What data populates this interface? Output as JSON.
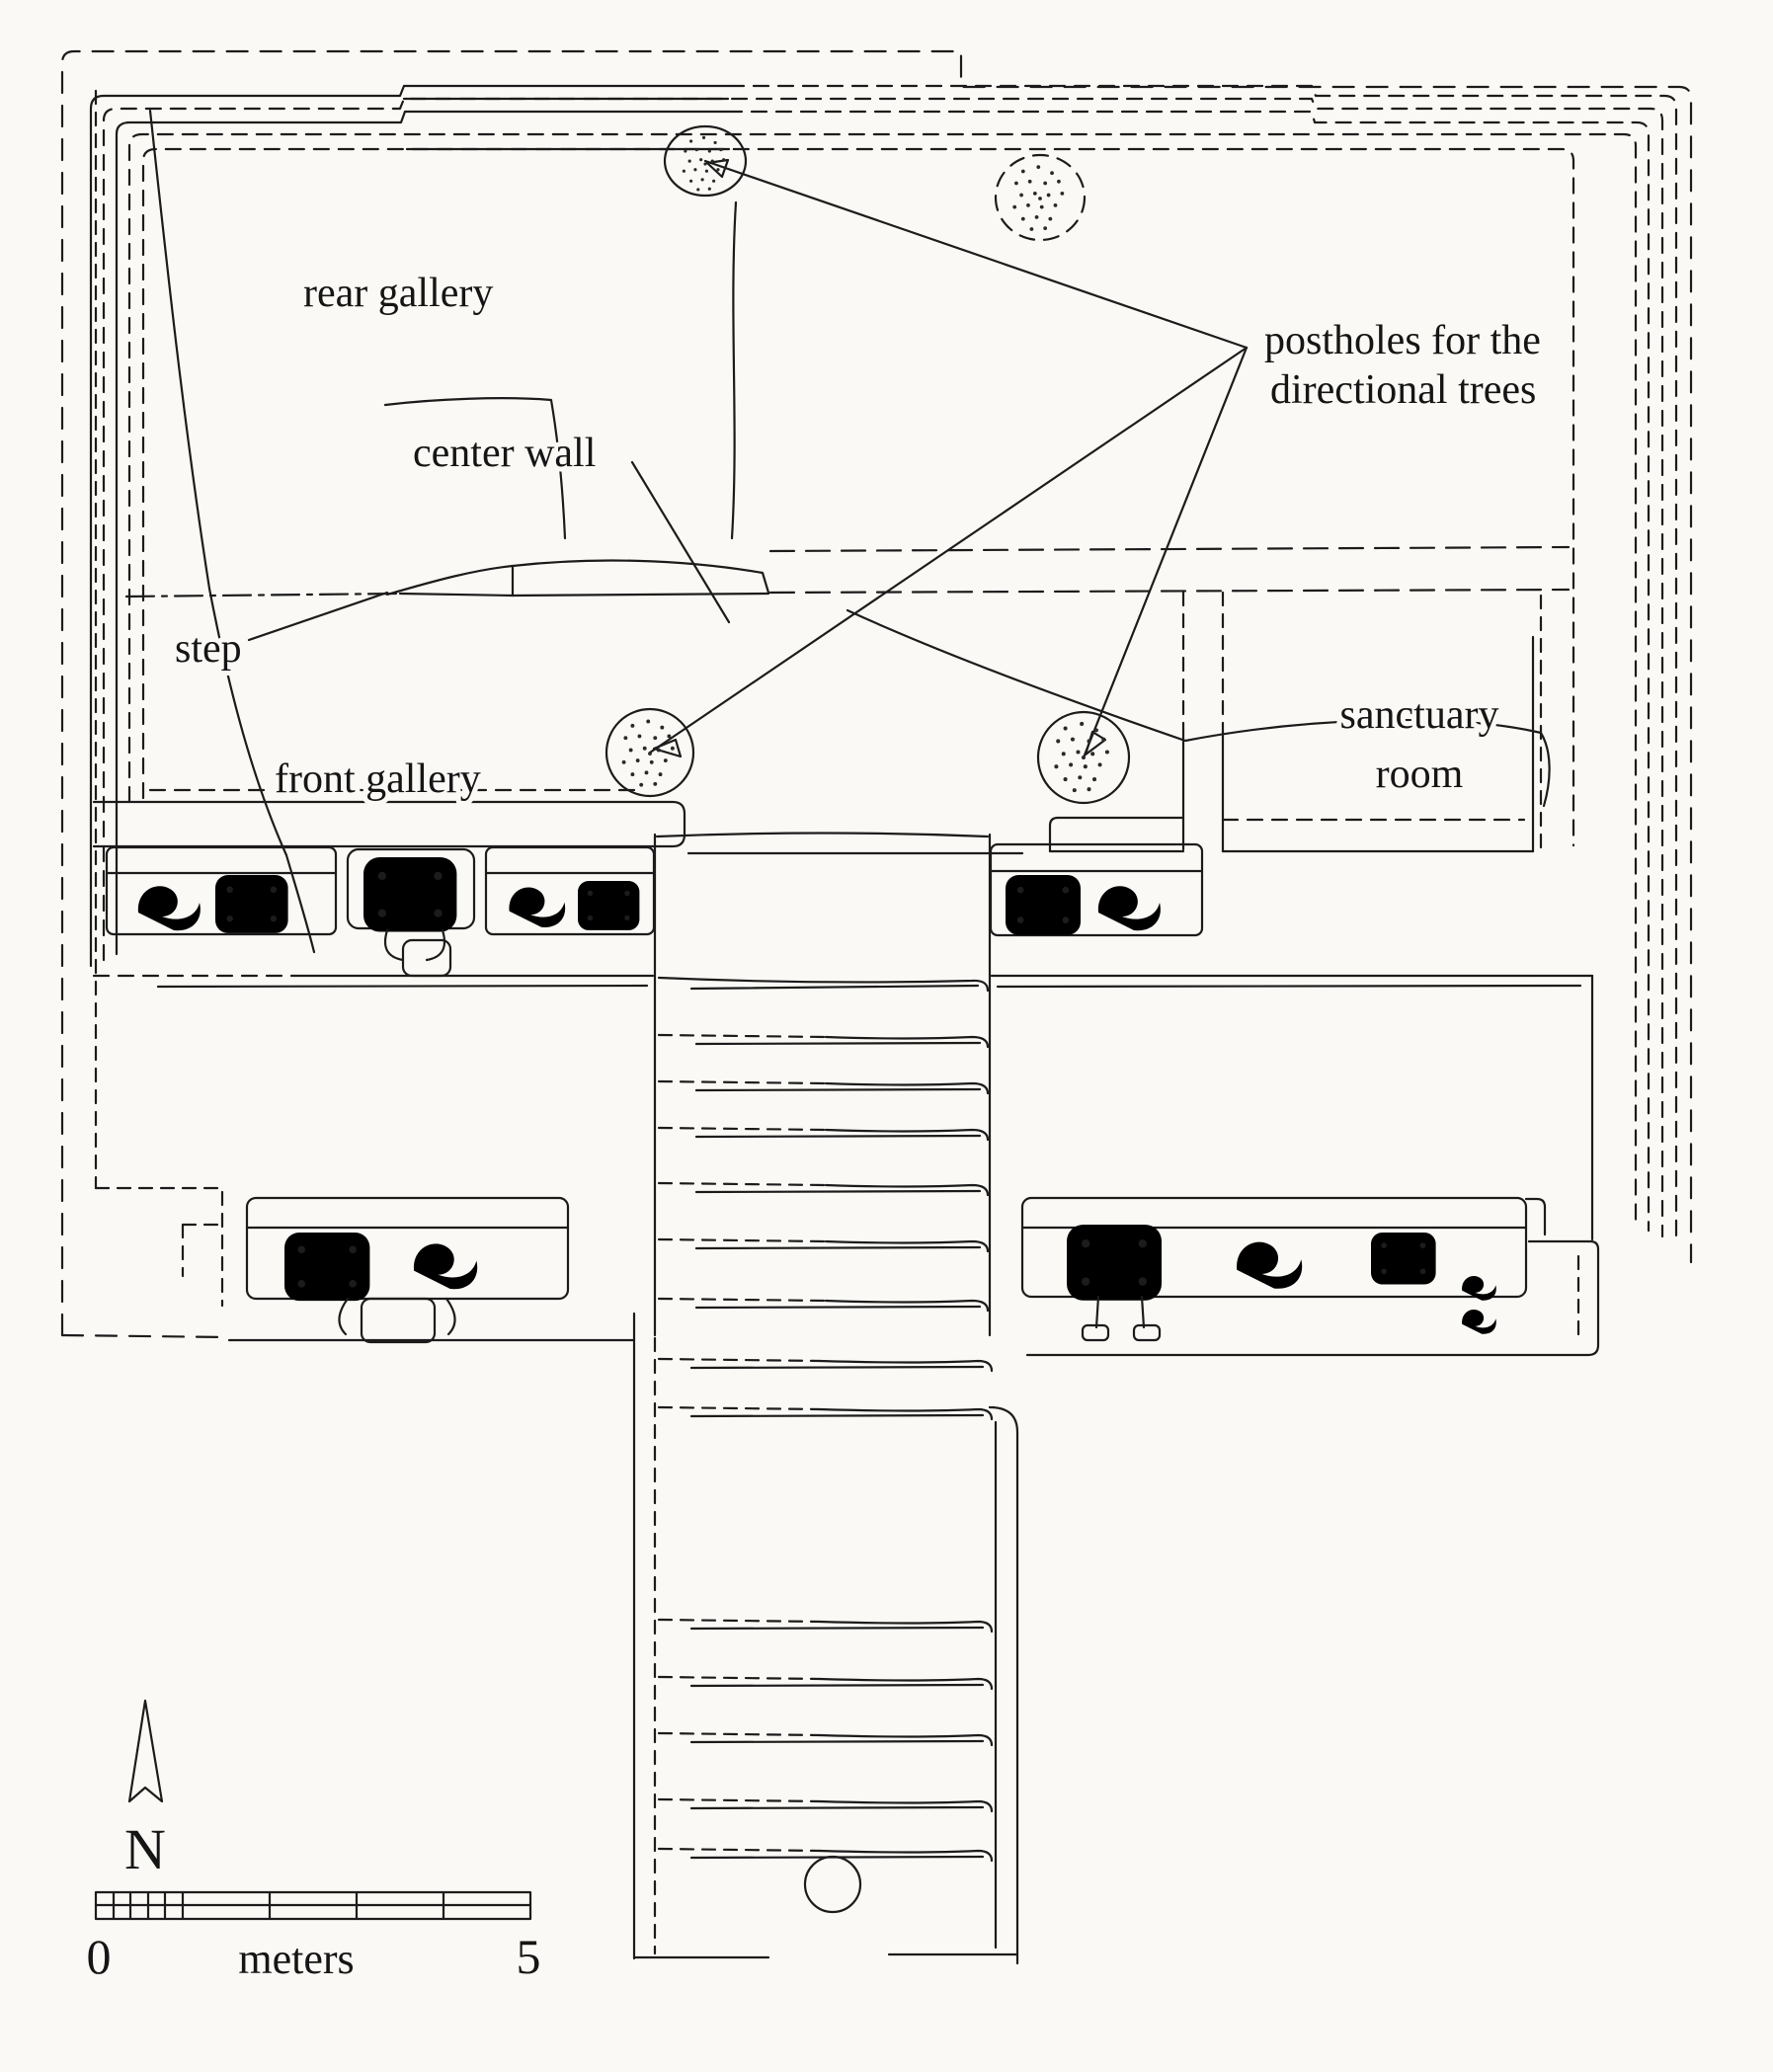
{
  "figure": {
    "kind": "archaeological temple plan (line drawing)",
    "labels": {
      "rear_gallery": "rear gallery",
      "center_wall": "center wall",
      "step": "step",
      "front_gallery": "front gallery",
      "sanctuary_room": {
        "line1": "sanctuary",
        "line2": "room"
      },
      "postholes": {
        "line1": "postholes for the",
        "line2": "directional trees"
      }
    },
    "compass": {
      "north": "N"
    },
    "scale_bar": {
      "start_value": "0",
      "end_value": "5",
      "unit_label": "meters"
    },
    "colors": {
      "ink": "#1c1c1c",
      "paper": "#faf9f5",
      "crack": "#8f8f8f"
    }
  }
}
